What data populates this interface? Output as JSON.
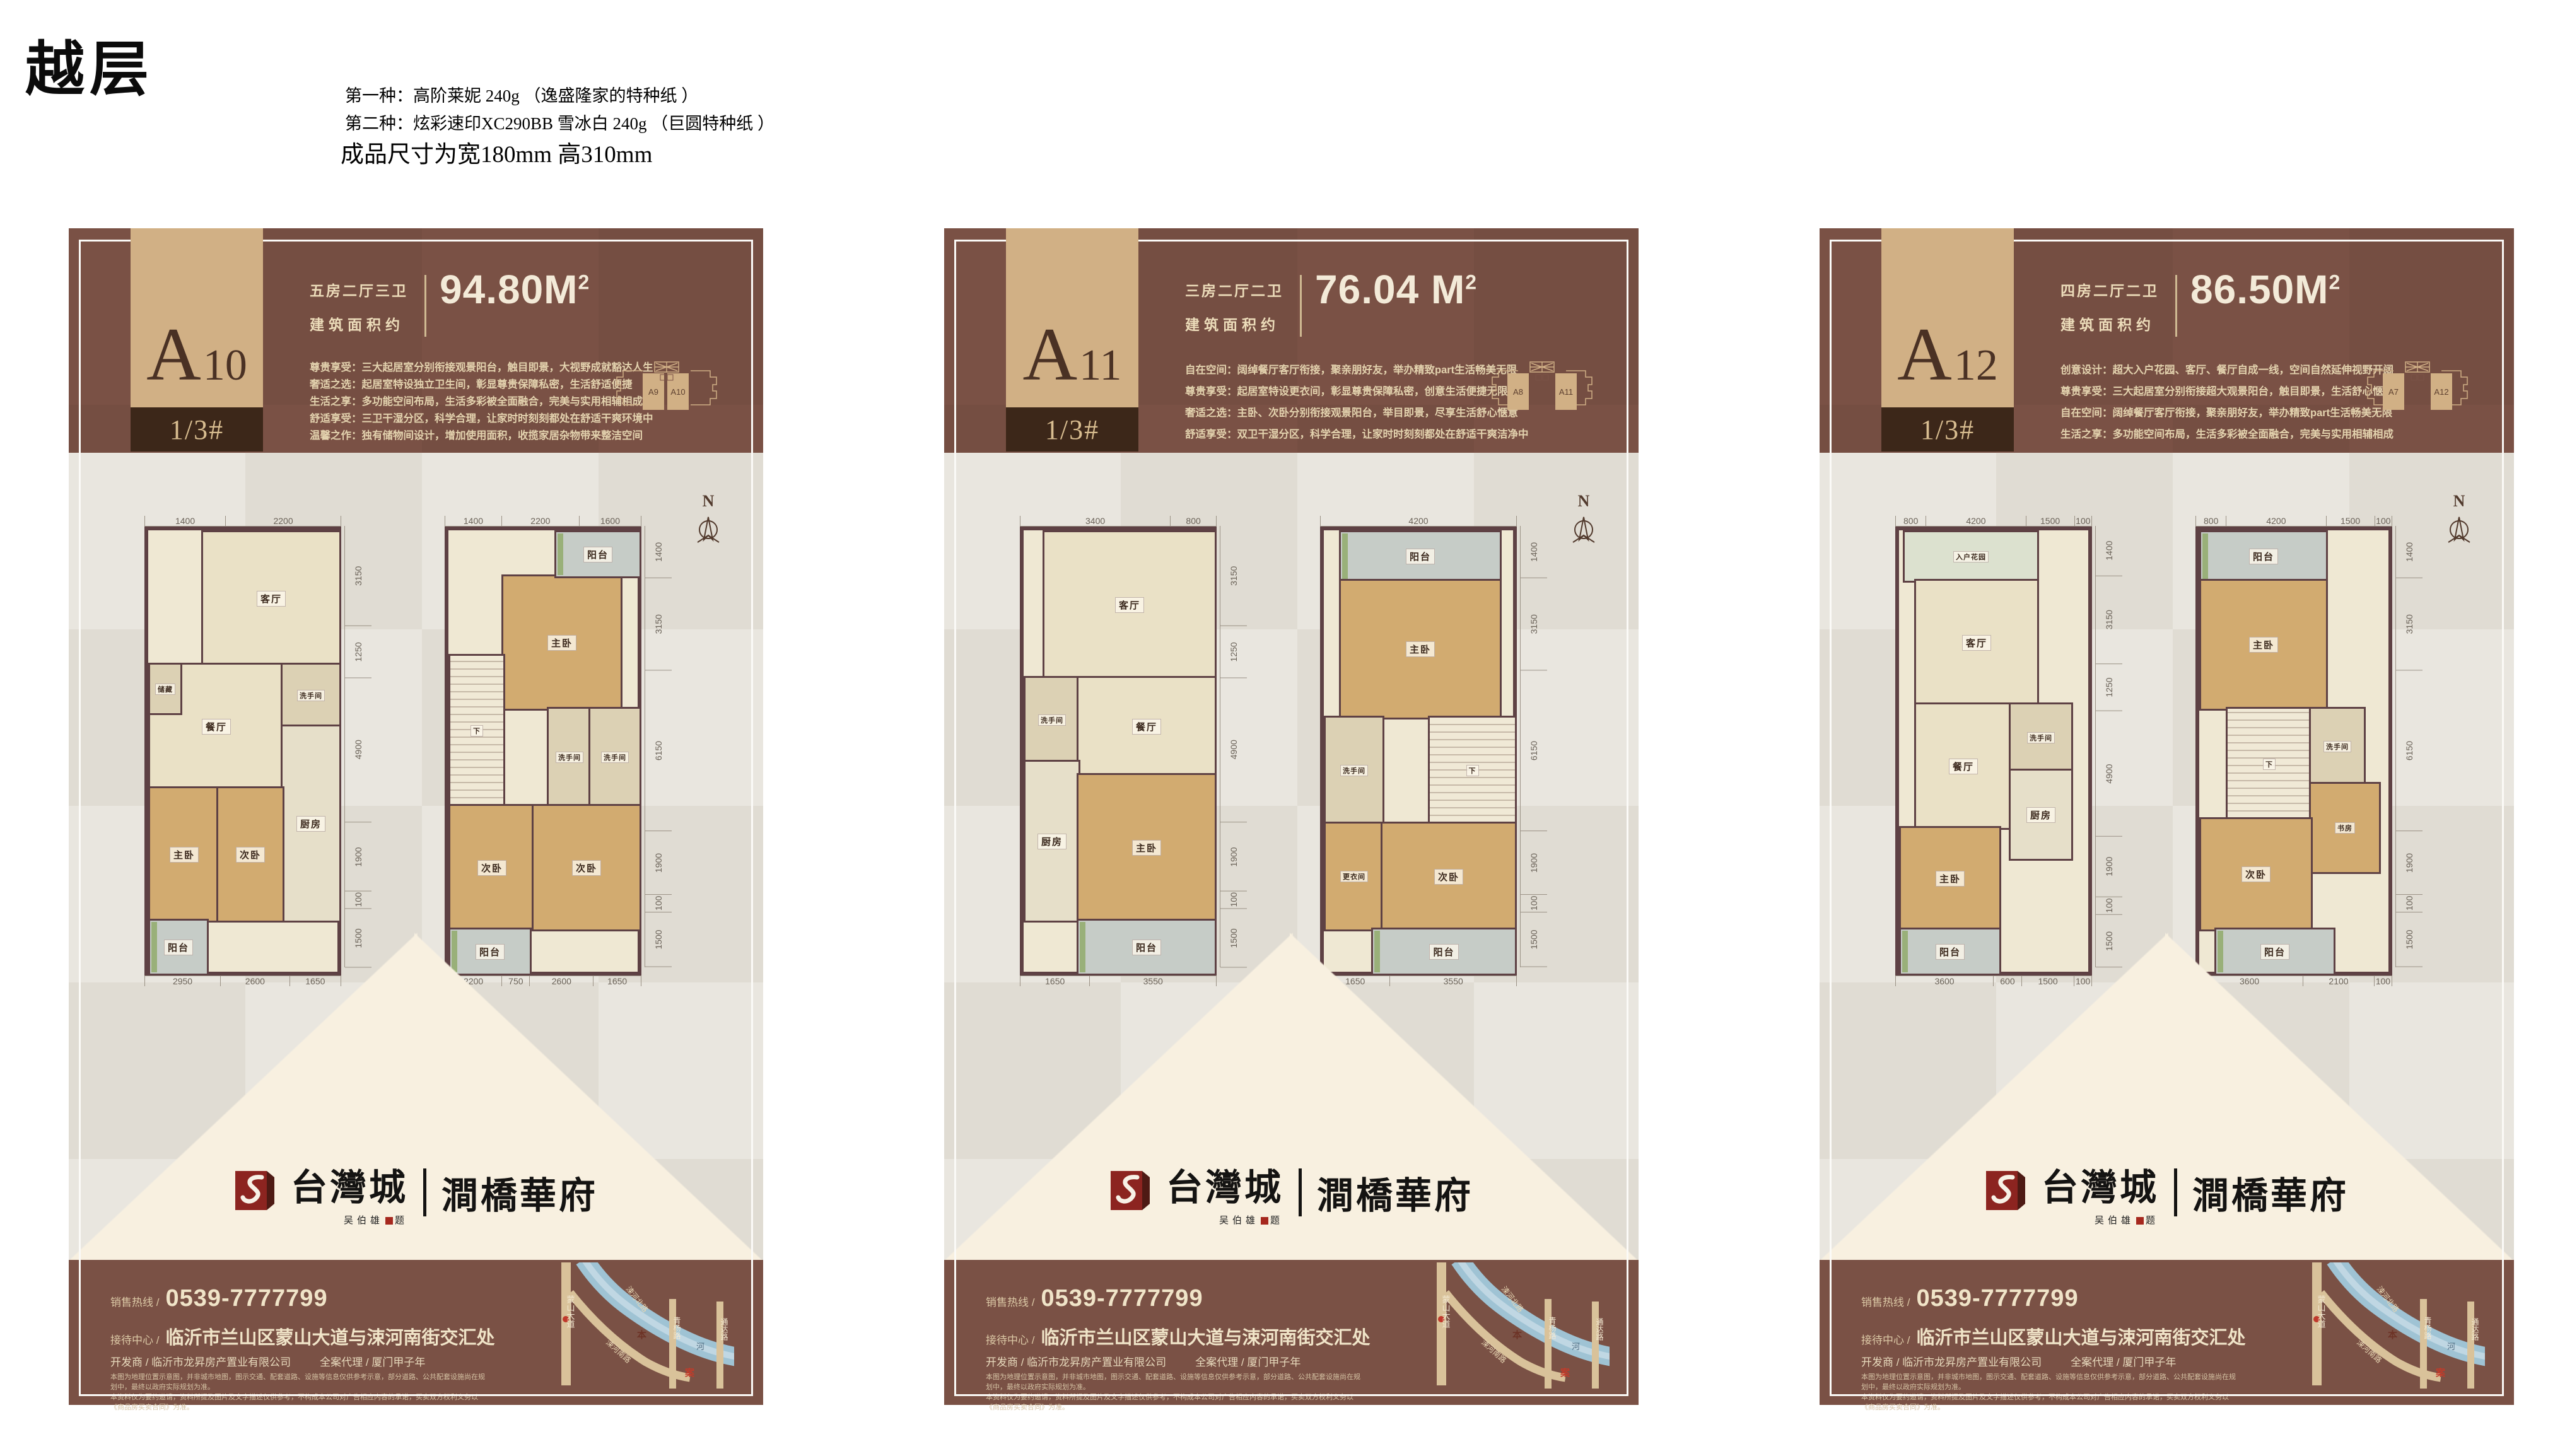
{
  "annotations": {
    "title": "越层",
    "paper_line1": "第一种：高阶莱妮 240g （逸盛隆家的特种纸 ）",
    "paper_line2": "第二种：炫彩速印XC290BB 雪冰白 240g （巨圆特种纸 ）",
    "size_note": "成品尺寸为宽180mm  高310mm"
  },
  "colors": {
    "brown": "#7a5145",
    "tan": "#d1b085",
    "dark_box": "#3c2719",
    "cream_text": "#ecdcba",
    "logo_red": "#8c2420",
    "wall": "#5e4144"
  },
  "shared": {
    "block_label": "1/3#",
    "area_label": "建筑面积约",
    "area_sup": "2",
    "compass_n": "N",
    "hotline_label": "销售热线 /",
    "hotline_number": "0539-7777799",
    "center_label": "接待中心 /",
    "center_address": "临沂市兰山区蒙山大道与涑河南街交汇处",
    "developer_line": "开发商 / 临沂市龙昇房产置业有限公司",
    "agency_line": "全案代理 / 厦门甲子年",
    "disclaimer_line1": "本图为地理位置示意图，并非城市地图，图示交通、配套道路、设施等信息仅供参考示意，部分道路、公共配套设施尚在规划中，最终以政府实际规划为准。",
    "disclaimer_line2": "本资料仅为要约邀请，资料所提及图片及文字描述仅供参考，不构成本公司对广告相应内容的承诺，买卖双方权利义务以《商品房买卖合同》为准。",
    "logo": {
      "brand": "台灣城",
      "estate": "澗橋華府",
      "signature_name": "吴伯雄",
      "signature_suffix": "题"
    },
    "map": {
      "road_left": "蒙山大道",
      "road_north": "涑河北路",
      "road_mid": "青杨路",
      "road_right": "通达路",
      "road_south": "涑河南路",
      "river": "河",
      "marker_top": "本",
      "marker_bottom": "案"
    }
  },
  "cards": [
    {
      "unit_letter": "A",
      "unit_number": "10",
      "spec": "五房二厅三卫",
      "area": "94.80M",
      "area_sup": "2",
      "features": [
        "尊贵享受：三大起居室分别衔接观景阳台，触目即景，大视野成就豁达人生",
        "奢适之选：起居室特设独立卫生间，彰显尊贵保障私密，生活舒适便捷",
        "生活之享：多功能空间布局，生活多彩被全面融合，完美与实用相辅相成",
        "舒适享受：三卫干湿分区，科学合理，让家时时刻刻都处在舒适干爽环境中",
        "温馨之作：独有储物间设计，增加使用面积，收揽家居杂物带来整洁空间"
      ],
      "siteplan": {
        "left_unit": "A9",
        "right_unit": "A10",
        "adjacent": true
      },
      "plans": [
        {
          "dims_top": [
            "1400",
            "2200"
          ],
          "dims_right": [
            "3150",
            "1250",
            "4900",
            "1900",
            "100",
            "1500"
          ],
          "dims_bottom": [
            "2950",
            "2600",
            "1650"
          ],
          "rooms": [
            {
              "label": "客厅",
              "x": 28,
              "y": 0,
              "w": 72,
              "h": 30,
              "f": "tile"
            },
            {
              "label": "餐厅",
              "x": 0,
              "y": 30,
              "w": 70,
              "h": 28,
              "f": "tile"
            },
            {
              "label": "储藏",
              "x": 0,
              "y": 30,
              "w": 16,
              "h": 11,
              "f": "bath",
              "s": 1
            },
            {
              "label": "洗手间",
              "x": 70,
              "y": 30,
              "w": 30,
              "h": 14,
              "f": "bath",
              "s": 1
            },
            {
              "label": "厨房",
              "x": 70,
              "y": 44,
              "w": 30,
              "h": 44,
              "f": "kit"
            },
            {
              "label": "主卧",
              "x": 0,
              "y": 58,
              "w": 36,
              "h": 30,
              "f": "wood"
            },
            {
              "label": "次卧",
              "x": 36,
              "y": 58,
              "w": 34,
              "h": 30,
              "f": "wood"
            },
            {
              "label": "阳台",
              "x": 0,
              "y": 88,
              "w": 30,
              "h": 12,
              "f": "balc"
            }
          ]
        },
        {
          "dims_top": [
            "1400",
            "2200",
            "1600"
          ],
          "dims_right": [
            "1400",
            "3150",
            "6150",
            "1900",
            "100",
            "1500"
          ],
          "dims_bottom": [
            "2200",
            "750",
            "2600",
            "1650"
          ],
          "rooms": [
            {
              "label": "主卧",
              "x": 28,
              "y": 10,
              "w": 62,
              "h": 30,
              "f": "wood"
            },
            {
              "label": "阳台",
              "x": 56,
              "y": 0,
              "w": 44,
              "h": 10,
              "f": "balc"
            },
            {
              "label": "下",
              "x": 0,
              "y": 28,
              "w": 28,
              "h": 34,
              "f": "stair",
              "s": 1
            },
            {
              "label": "洗手间",
              "x": 52,
              "y": 40,
              "w": 22,
              "h": 22,
              "f": "bath",
              "s": 1
            },
            {
              "label": "洗手间",
              "x": 74,
              "y": 40,
              "w": 26,
              "h": 22,
              "f": "bath",
              "s": 1
            },
            {
              "label": "次卧",
              "x": 0,
              "y": 62,
              "w": 44,
              "h": 28,
              "f": "wood"
            },
            {
              "label": "次卧",
              "x": 44,
              "y": 62,
              "w": 56,
              "h": 28,
              "f": "wood"
            },
            {
              "label": "阳台",
              "x": 0,
              "y": 90,
              "w": 42,
              "h": 10,
              "f": "balc"
            }
          ]
        }
      ]
    },
    {
      "unit_letter": "A",
      "unit_number": "11",
      "spec": "三房二厅二卫",
      "area": "76.04 M",
      "area_sup": "2",
      "features": [
        "自在空间：阔绰餐厅客厅衔接，聚亲朋好友，举办精致part生活畅美无限",
        "尊贵享受：起居室特设更衣间，彰显尊贵保障私密，创意生活便捷无限",
        "奢适之选：主卧、次卧分别衔接观景阳台，举目即景，尽享生活舒心惬意",
        "舒适享受：双卫干湿分区，科学合理，让家时时刻刻都处在舒适干爽洁净中"
      ],
      "siteplan": {
        "left_unit": "A8",
        "right_unit": "A11",
        "adjacent": false
      },
      "plans": [
        {
          "dims_top": [
            "3400",
            "800"
          ],
          "dims_right": [
            "3150",
            "1250",
            "4900",
            "1900",
            "100",
            "1500"
          ],
          "dims_bottom": [
            "1650",
            "3550"
          ],
          "rooms": [
            {
              "label": "客厅",
              "x": 10,
              "y": 0,
              "w": 90,
              "h": 33,
              "f": "tile"
            },
            {
              "label": "洗手间",
              "x": 0,
              "y": 33,
              "w": 28,
              "h": 19,
              "f": "bath",
              "s": 1
            },
            {
              "label": "餐厅",
              "x": 28,
              "y": 33,
              "w": 72,
              "h": 22,
              "f": "tile"
            },
            {
              "label": "厨房",
              "x": 0,
              "y": 52,
              "w": 28,
              "h": 36,
              "f": "kit"
            },
            {
              "label": "主卧",
              "x": 28,
              "y": 55,
              "w": 72,
              "h": 33,
              "f": "wood"
            },
            {
              "label": "阳台",
              "x": 28,
              "y": 88,
              "w": 72,
              "h": 12,
              "f": "balc"
            }
          ]
        },
        {
          "dims_top": [
            "4200"
          ],
          "dims_right": [
            "1400",
            "3150",
            "6150",
            "1900",
            "100",
            "1500"
          ],
          "dims_bottom": [
            "1650",
            "3550"
          ],
          "rooms": [
            {
              "label": "阳台",
              "x": 8,
              "y": 0,
              "w": 84,
              "h": 11,
              "f": "balc"
            },
            {
              "label": "主卧",
              "x": 8,
              "y": 11,
              "w": 84,
              "h": 31,
              "f": "wood"
            },
            {
              "label": "洗手间",
              "x": 0,
              "y": 42,
              "w": 30,
              "h": 24,
              "f": "bath",
              "s": 1
            },
            {
              "label": "下",
              "x": 55,
              "y": 42,
              "w": 45,
              "h": 24,
              "f": "stair",
              "s": 1
            },
            {
              "label": "更衣间",
              "x": 0,
              "y": 66,
              "w": 30,
              "h": 24,
              "f": "wood",
              "s": 1
            },
            {
              "label": "次卧",
              "x": 30,
              "y": 66,
              "w": 70,
              "h": 24,
              "f": "wood"
            },
            {
              "label": "阳台",
              "x": 25,
              "y": 90,
              "w": 75,
              "h": 10,
              "f": "balc"
            }
          ]
        }
      ]
    },
    {
      "unit_letter": "A",
      "unit_number": "12",
      "spec": "四房二厅二卫",
      "area": "86.50M",
      "area_sup": "2",
      "features": [
        "创意设计：超大入户花园、客厅、餐厅自成一线，空间自然延伸视野开阔",
        "尊贵享受：三大起居室分别衔接超大观景阳台，触目即景，生活舒心惬意",
        "自在空间：阔绰餐厅客厅衔接，聚亲朋好友，举办精致part生活畅美无限",
        "生活之享：多功能空间布局，生活多彩被全面融合，完美与实用相辅相成"
      ],
      "siteplan": {
        "left_unit": "A7",
        "right_unit": "A12",
        "adjacent": false
      },
      "plans": [
        {
          "dims_top": [
            "800",
            "4200",
            "1500",
            "100"
          ],
          "dims_right": [
            "1400",
            "3150",
            "1250",
            "4900",
            "1900",
            "100",
            "1500"
          ],
          "dims_bottom": [
            "3600",
            "600",
            "1500",
            "100"
          ],
          "rooms": [
            {
              "label": "入户花园",
              "x": 2,
              "y": 0,
              "w": 70,
              "h": 11,
              "f": "gard",
              "s": 1
            },
            {
              "label": "客厅",
              "x": 8,
              "y": 11,
              "w": 64,
              "h": 28,
              "f": "tile"
            },
            {
              "label": "餐厅",
              "x": 8,
              "y": 39,
              "w": 50,
              "h": 28,
              "f": "tile"
            },
            {
              "label": "洗手间",
              "x": 58,
              "y": 39,
              "w": 32,
              "h": 15,
              "f": "bath",
              "s": 1
            },
            {
              "label": "厨房",
              "x": 58,
              "y": 54,
              "w": 32,
              "h": 20,
              "f": "kit"
            },
            {
              "label": "主卧",
              "x": 0,
              "y": 67,
              "w": 52,
              "h": 23,
              "f": "wood"
            },
            {
              "label": "阳台",
              "x": 0,
              "y": 90,
              "w": 52,
              "h": 10,
              "f": "balc"
            }
          ]
        },
        {
          "dims_top": [
            "800",
            "4200",
            "1500",
            "100"
          ],
          "dims_right": [
            "1400",
            "3150",
            "6150",
            "1900",
            "100",
            "1500"
          ],
          "dims_bottom": [
            "3600",
            "2100",
            "100"
          ],
          "rooms": [
            {
              "label": "阳台",
              "x": 0,
              "y": 0,
              "w": 66,
              "h": 11,
              "f": "balc"
            },
            {
              "label": "主卧",
              "x": 0,
              "y": 11,
              "w": 66,
              "h": 29,
              "f": "wood"
            },
            {
              "label": "下",
              "x": 14,
              "y": 40,
              "w": 44,
              "h": 25,
              "f": "stair",
              "s": 1
            },
            {
              "label": "洗手间",
              "x": 58,
              "y": 40,
              "w": 28,
              "h": 17,
              "f": "bath",
              "s": 1
            },
            {
              "label": "书房",
              "x": 58,
              "y": 57,
              "w": 36,
              "h": 20,
              "f": "wood",
              "s": 1
            },
            {
              "label": "次卧",
              "x": 0,
              "y": 65,
              "w": 58,
              "h": 25,
              "f": "wood"
            },
            {
              "label": "阳台",
              "x": 8,
              "y": 90,
              "w": 62,
              "h": 10,
              "f": "balc"
            }
          ]
        }
      ]
    }
  ]
}
